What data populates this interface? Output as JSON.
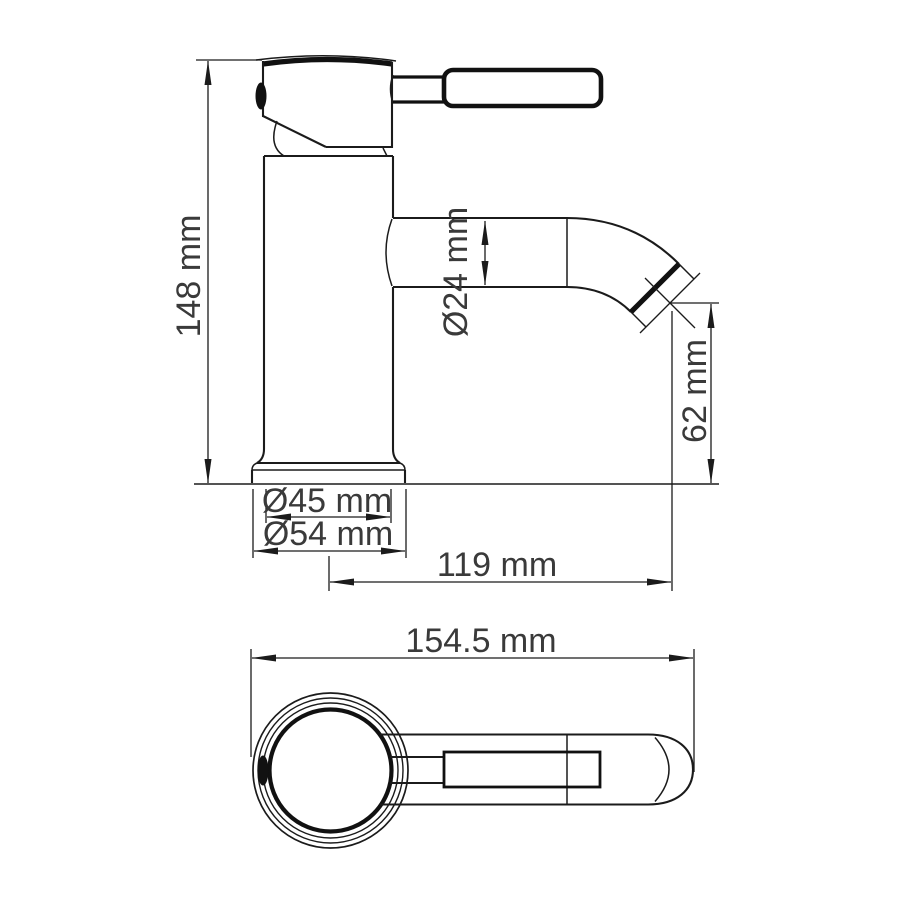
{
  "colors": {
    "background": "#ffffff",
    "line": "#1b1b1b",
    "text": "#3a3a3a"
  },
  "side_view": {
    "dimensions": {
      "overall_height": "148 mm",
      "spout_diameter": "Ø24 mm",
      "outlet_height": "62 mm",
      "body_diameter": "Ø45 mm",
      "base_diameter": "Ø54 mm",
      "spout_reach": "119 mm"
    }
  },
  "top_view": {
    "dimensions": {
      "overall_length": "154.5 mm"
    }
  }
}
